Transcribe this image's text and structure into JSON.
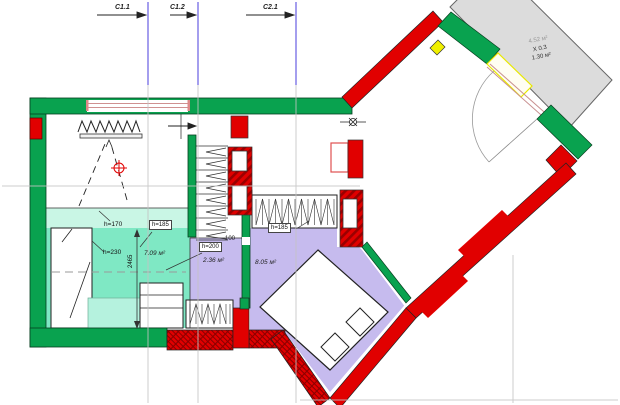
{
  "title": "Apartment floor plan with section marks",
  "sections": {
    "c11": "C1.1",
    "c12": "C1.2",
    "c21": "C2.1"
  },
  "living_room": {
    "h_zone_left": "h=170",
    "h_zone_mid": "h=185",
    "h_zone_bed": "h=230",
    "area": "7.09 м²",
    "dim_depth": "2465"
  },
  "hall": {
    "h_zone": "h=200",
    "area": "2.36 м²",
    "dim_wall": "100"
  },
  "bedroom": {
    "h_zone": "h=185",
    "area": "8.05 м²"
  },
  "balcony": {
    "area": "4.52 м²",
    "coefficient": "X 0.3",
    "reduced_area": "1.30 м²"
  },
  "colors": {
    "wall_green": "#09a24f",
    "wall_red": "#e10000",
    "wall_red_dark": "#8a0000",
    "room_teal": "#7fe8c4",
    "room_teal_light": "#c9f6e5",
    "room_purple": "#c6bbee",
    "balcony_gray": "#dcdcdc",
    "accent_yellow": "#f0f000",
    "section_line_blue": "#5b51e0",
    "ref_line_gray": "#c4c4c4",
    "window_pink": "#cf9090"
  }
}
